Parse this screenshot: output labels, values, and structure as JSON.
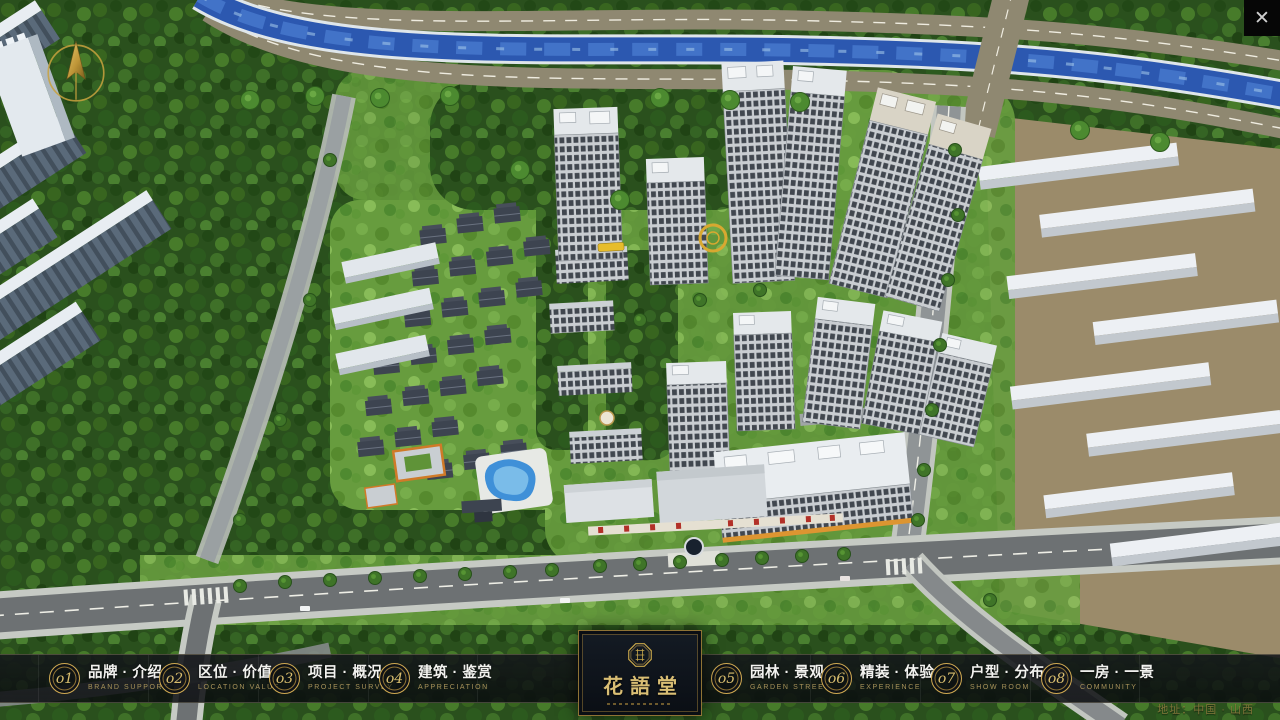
{
  "chrome": {
    "close_icon": "✕"
  },
  "nav": {
    "items": [
      {
        "num": "o1",
        "title": "品牌 · 介绍",
        "subtitle": "BRAND SUPPORT"
      },
      {
        "num": "o2",
        "title": "区位 · 价值",
        "subtitle": "LOCATION VALUE"
      },
      {
        "num": "o3",
        "title": "项目 · 概况",
        "subtitle": "PROJECT SURVEY"
      },
      {
        "num": "o4",
        "title": "建筑 · 鉴赏",
        "subtitle": "APPRECIATION"
      },
      {
        "num": "o5",
        "title": "园林 · 景观",
        "subtitle": "GARDEN STREET"
      },
      {
        "num": "o6",
        "title": "精装 · 体验",
        "subtitle": "EXPERIENCE"
      },
      {
        "num": "o7",
        "title": "户型 · 分布",
        "subtitle": "SHOW ROOM"
      },
      {
        "num": "o8",
        "title": "一房 · 一景",
        "subtitle": "COMMUNITY"
      }
    ]
  },
  "logo": {
    "title": "花語堂"
  },
  "footer": {
    "address": "地址：中国 · 山西"
  },
  "colors": {
    "accent_gold": "#c9a84c",
    "nav_background": "#0c0e12",
    "river_blue": "#2c58b0",
    "foliage_green": "#2e5520",
    "tower_orange_trim": "#dd9531"
  }
}
